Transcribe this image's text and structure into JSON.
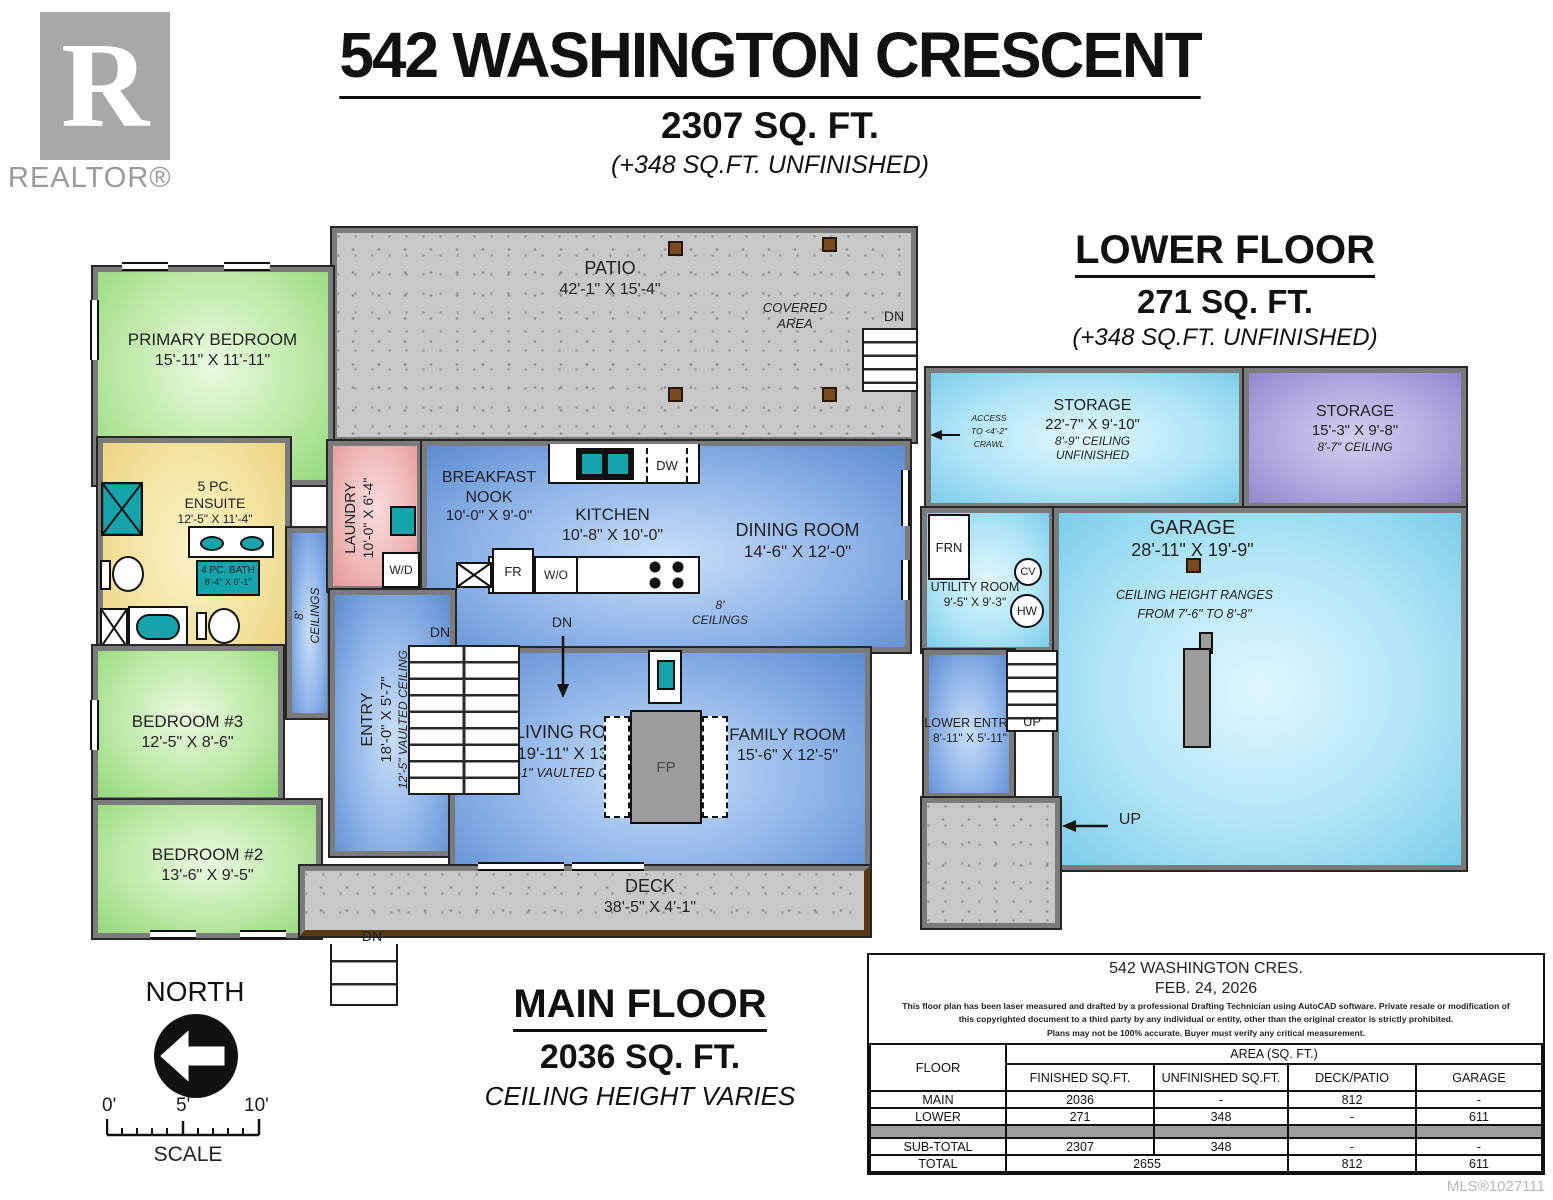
{
  "branding": {
    "logo_letter": "R",
    "logo_text": "REALTOR®"
  },
  "header": {
    "title": "542 WASHINGTON CRESCENT",
    "area": "2307 SQ. FT.",
    "unfinished": "(+348 SQ.FT. UNFINISHED)"
  },
  "labels": {
    "dn": "DN",
    "up": "UP",
    "north": "NORTH",
    "scale": "SCALE",
    "fp": "FP",
    "wd": "W/D",
    "dw": "DW",
    "fr": "FR",
    "wo": "W/O",
    "frn": "FRN",
    "cv": "CV",
    "hw": "HW"
  },
  "main_floor": {
    "title": "MAIN FLOOR",
    "area": "2036 SQ. FT.",
    "note": "CEILING HEIGHT VARIES",
    "ceilings_8": {
      "l1": "8'",
      "l2": "CEILINGS"
    },
    "rooms": {
      "patio": {
        "name": "PATIO",
        "dims": "42'-1\" X 15'-4\"",
        "note_l1": "COVERED",
        "note_l2": "AREA"
      },
      "primary_bedroom": {
        "name": "PRIMARY BEDROOM",
        "dims": "15'-11\" X 11'-11\""
      },
      "ensuite": {
        "name_l1": "5 PC.",
        "name_l2": "ENSUITE",
        "dims": "12'-5\" X 11'-4\""
      },
      "bath": {
        "name": "4 PC. BATH",
        "dims": "8'-4\" X 6'-1\""
      },
      "bedroom3": {
        "name": "BEDROOM #3",
        "dims": "12'-5\" X 8'-6\""
      },
      "bedroom2": {
        "name": "BEDROOM #2",
        "dims": "13'-6\" X 9'-5\""
      },
      "laundry": {
        "name": "LAUNDRY",
        "dims": "10'-0\" X 6'-4\""
      },
      "breakfast_nook": {
        "name_l1": "BREAKFAST",
        "name_l2": "NOOK",
        "dims": "10'-0\" X 9'-0\""
      },
      "kitchen": {
        "name": "KITCHEN",
        "dims": "10'-8\" X 10'-0\""
      },
      "dining": {
        "name": "DINING ROOM",
        "dims": "14'-6\" X 12'-0\""
      },
      "entry": {
        "name": "ENTRY",
        "dims": "18'-0\" X 5'-7\"",
        "note": "12'-5\" VAULTED CEILING"
      },
      "living": {
        "name": "LIVING ROOM",
        "dims": "19'-11\" X 13'-5\"",
        "note": "13'-1\" VAULTED CEILING"
      },
      "family": {
        "name": "FAMILY ROOM",
        "dims": "15'-6\" X 12'-5\""
      },
      "deck": {
        "name": "DECK",
        "dims": "38'-5\" X 4'-1\""
      }
    }
  },
  "lower_floor": {
    "title": "LOWER FLOOR",
    "area": "271 SQ. FT.",
    "unfinished": "(+348 SQ.FT. UNFINISHED)",
    "rooms": {
      "storage1": {
        "name": "STORAGE",
        "dims": "22'-7\" X 9'-10\"",
        "note1": "8'-9\" CEILING",
        "note2": "UNFINISHED",
        "access_l1": "ACCESS",
        "access_l2": "TO <4'-2\"",
        "access_l3": "CRAWL"
      },
      "storage2": {
        "name": "STORAGE",
        "dims": "15'-3\" X 9'-8\"",
        "note1": "8'-7\" CEILING"
      },
      "utility": {
        "name": "UTILITY ROOM",
        "dims": "9'-5\" X 9'-3\""
      },
      "garage": {
        "name": "GARAGE",
        "dims": "28'-11\" X 19'-9\"",
        "note_l1": "CEILING HEIGHT RANGES",
        "note_l2": "FROM 7'-6\" TO 8'-8\""
      },
      "lower_entry": {
        "name": "LOWER ENTRY",
        "dims": "8'-11\" X 5'-11\""
      }
    }
  },
  "scale_bar": {
    "t0": "0'",
    "t5": "5'",
    "t10": "10'"
  },
  "info_table": {
    "title": "542 WASHINGTON CRES.",
    "date": "FEB. 24, 2026",
    "disclaimer": {
      "l1": "This floor plan has been laser measured and drafted by a professional Drafting Technician using AutoCAD software. Private resale or modification of",
      "l2": "this copyrighted document to a third party by any individual or entity, other than the original creator is strictly prohibited.",
      "l3": "Plans may not be 100% accurate.  Buyer must verify any critical measurement."
    },
    "col_floor": "FLOOR",
    "area_header": "AREA (SQ. FT.)",
    "columns": {
      "c1": "FINISHED SQ.FT.",
      "c2": "UNFINISHED SQ.FT.",
      "c3": "DECK/PATIO",
      "c4": "GARAGE"
    },
    "rows": {
      "main": {
        "floor": "MAIN",
        "c1": "2036",
        "c2": "-",
        "c3": "812",
        "c4": "-"
      },
      "lower": {
        "floor": "LOWER",
        "c1": "271",
        "c2": "348",
        "c3": "-",
        "c4": "611"
      },
      "subtotal": {
        "floor": "SUB-TOTAL",
        "c1": "2307",
        "c2": "348",
        "c3": "-",
        "c4": "-"
      },
      "total": {
        "floor": "TOTAL",
        "c12": "2655",
        "c3": "812",
        "c4": "611"
      }
    }
  },
  "footer": {
    "mls": "MLS®1027111"
  }
}
